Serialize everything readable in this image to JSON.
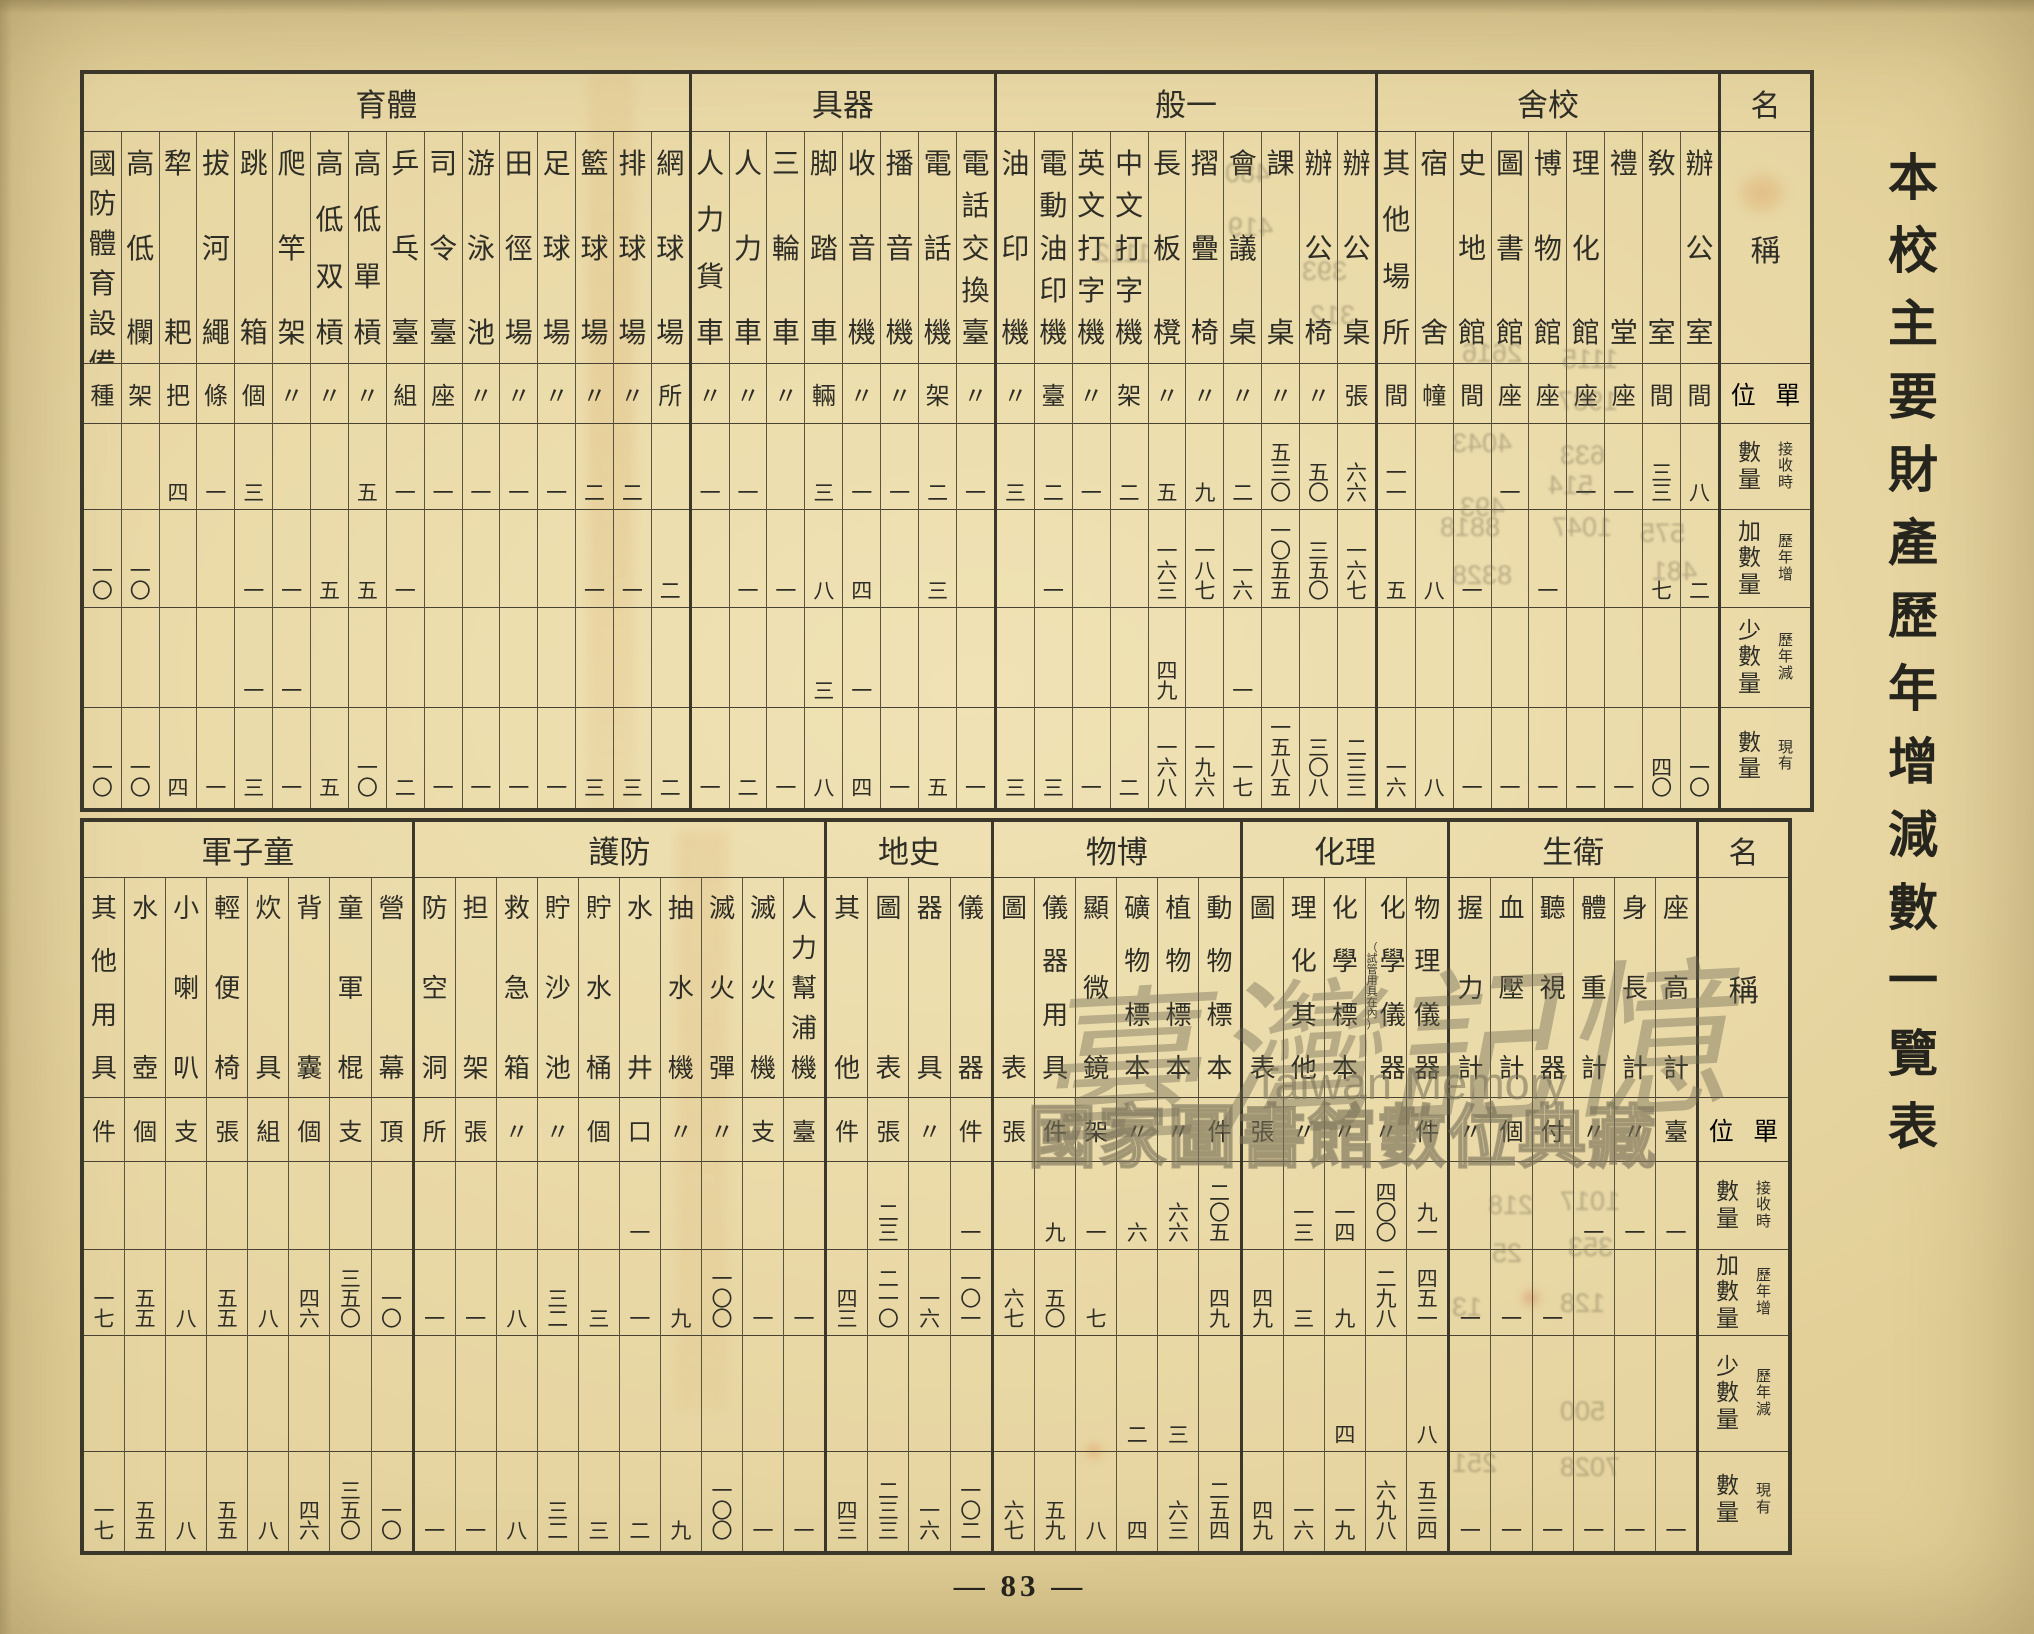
{
  "page": {
    "vertical_title": "本校主要財產歷年增減數一覽表",
    "page_number": "— 83 —",
    "watermark": {
      "line1": "臺灣記憶",
      "line2": "Taiwan Memory",
      "line3": "國家圖書館數位典藏"
    },
    "ink_color": "#2f2e26",
    "paper_color": "#e9d8a5",
    "line_color": "#474234"
  },
  "row_labels": {
    "name_header": "名",
    "item_header": "稱",
    "unit_label": "單位",
    "qty_rows": [
      {
        "main": "數量",
        "sub": "接收時"
      },
      {
        "main": "加數量",
        "sub": "歷年增"
      },
      {
        "main": "少數量",
        "sub": "歷年減"
      },
      {
        "main": "數量",
        "sub": "現有"
      }
    ]
  },
  "top_table": {
    "sections": [
      {
        "title": "校舍",
        "key": "school-buildings",
        "items": [
          {
            "name": "辦公室",
            "unit": "間",
            "received": "八",
            "added": "二",
            "reduced": "",
            "current": "一〇"
          },
          {
            "name": "敎室",
            "unit": "間",
            "received": "三三",
            "added": "七",
            "reduced": "",
            "current": "四〇"
          },
          {
            "name": "禮堂",
            "unit": "座",
            "received": "一",
            "added": "",
            "reduced": "",
            "current": "一"
          },
          {
            "name": "理化館",
            "unit": "座",
            "received": "一",
            "added": "",
            "reduced": "",
            "current": "一"
          },
          {
            "name": "博物館",
            "unit": "座",
            "received": "",
            "added": "一",
            "reduced": "",
            "current": "一"
          },
          {
            "name": "圖書館",
            "unit": "座",
            "received": "一",
            "added": "",
            "reduced": "",
            "current": "一"
          },
          {
            "name": "史地館",
            "unit": "間",
            "received": "",
            "added": "一",
            "reduced": "",
            "current": "一"
          },
          {
            "name": "宿舍",
            "unit": "幢",
            "received": "",
            "added": "八",
            "reduced": "",
            "current": "八"
          },
          {
            "name": "其他場所",
            "unit": "間",
            "received": "一一",
            "added": "五",
            "reduced": "",
            "current": "一六"
          }
        ]
      },
      {
        "title": "一般",
        "key": "general-furniture",
        "items": [
          {
            "name": "辦公桌",
            "unit": "張",
            "received": "六六",
            "added": "一六七",
            "reduced": "",
            "current": "二三三"
          },
          {
            "name": "辦公椅",
            "unit": "〃",
            "received": "五〇",
            "added": "三五〇",
            "reduced": "",
            "current": "三〇八"
          },
          {
            "name": "課桌",
            "unit": "〃",
            "received": "五三〇",
            "added": "一〇五五",
            "reduced": "",
            "current": "一五八五"
          },
          {
            "name": "會議桌",
            "unit": "〃",
            "received": "二",
            "added": "一六",
            "reduced": "一",
            "current": "一七"
          },
          {
            "name": "摺疊椅",
            "unit": "〃",
            "received": "九",
            "added": "一八七",
            "reduced": "",
            "current": "一九六"
          },
          {
            "name": "長板櫈",
            "unit": "〃",
            "received": "五",
            "added": "一六三",
            "reduced": "四九",
            "current": "一六八"
          },
          {
            "name": "中文打字機",
            "unit": "架",
            "received": "二",
            "added": "",
            "reduced": "",
            "current": "二"
          },
          {
            "name": "英文打字機",
            "unit": "〃",
            "received": "一",
            "added": "",
            "reduced": "",
            "current": "一"
          },
          {
            "name": "電動油印機",
            "unit": "臺",
            "received": "二",
            "added": "一",
            "reduced": "",
            "current": "三"
          },
          {
            "name": "油印機",
            "unit": "〃",
            "received": "三",
            "added": "",
            "reduced": "",
            "current": "三"
          }
        ]
      },
      {
        "title": "器具",
        "key": "equipment-vehicles",
        "items": [
          {
            "name": "電話交換臺",
            "unit": "〃",
            "received": "一",
            "added": "",
            "reduced": "",
            "current": "一"
          },
          {
            "name": "電話機",
            "unit": "架",
            "received": "二",
            "added": "三",
            "reduced": "",
            "current": "五"
          },
          {
            "name": "播音機",
            "unit": "〃",
            "received": "一",
            "added": "",
            "reduced": "",
            "current": "一"
          },
          {
            "name": "收音機",
            "unit": "〃",
            "received": "一",
            "added": "四",
            "reduced": "一",
            "current": "四"
          },
          {
            "name": "脚踏車",
            "unit": "輛",
            "received": "三",
            "added": "八",
            "reduced": "三",
            "current": "八"
          },
          {
            "name": "三輪車",
            "unit": "〃",
            "received": "",
            "added": "一",
            "reduced": "",
            "current": "一"
          },
          {
            "name": "人力車",
            "unit": "〃",
            "received": "一",
            "added": "一",
            "reduced": "",
            "current": "二"
          },
          {
            "name": "人力貨車",
            "unit": "〃",
            "received": "一",
            "added": "",
            "reduced": "",
            "current": "一"
          }
        ]
      },
      {
        "title": "體育",
        "key": "physical-education",
        "items": [
          {
            "name": "網球場",
            "unit": "所",
            "received": "",
            "added": "二",
            "reduced": "",
            "current": "二"
          },
          {
            "name": "排球場",
            "unit": "〃",
            "received": "二",
            "added": "一",
            "reduced": "",
            "current": "三"
          },
          {
            "name": "籃球場",
            "unit": "〃",
            "received": "二",
            "added": "一",
            "reduced": "",
            "current": "三"
          },
          {
            "name": "足球場",
            "unit": "〃",
            "received": "一",
            "added": "",
            "reduced": "",
            "current": "一"
          },
          {
            "name": "田徑場",
            "unit": "〃",
            "received": "一",
            "added": "",
            "reduced": "",
            "current": "一"
          },
          {
            "name": "游泳池",
            "unit": "〃",
            "received": "一",
            "added": "",
            "reduced": "",
            "current": "一"
          },
          {
            "name": "司令臺",
            "unit": "座",
            "received": "一",
            "added": "",
            "reduced": "",
            "current": "一"
          },
          {
            "name": "乒乓臺",
            "unit": "組",
            "received": "一",
            "added": "一",
            "reduced": "",
            "current": "二"
          },
          {
            "name": "高低單槓",
            "unit": "〃",
            "received": "五",
            "added": "五",
            "reduced": "",
            "current": "一〇"
          },
          {
            "name": "高低双槓",
            "unit": "〃",
            "received": "",
            "added": "五",
            "reduced": "",
            "current": "五"
          },
          {
            "name": "爬竿架",
            "unit": "〃",
            "received": "",
            "added": "一",
            "reduced": "一",
            "current": "一"
          },
          {
            "name": "跳箱",
            "unit": "個",
            "received": "三",
            "added": "一",
            "reduced": "一",
            "current": "三"
          },
          {
            "name": "拔河繩",
            "unit": "條",
            "received": "一",
            "added": "",
            "reduced": "",
            "current": "一"
          },
          {
            "name": "犂耙",
            "unit": "把",
            "received": "四",
            "added": "",
            "reduced": "",
            "current": "四"
          },
          {
            "name": "高低欄",
            "unit": "架",
            "received": "",
            "added": "一〇",
            "reduced": "",
            "current": "一〇"
          },
          {
            "name": "國防體育設備",
            "unit": "種",
            "received": "",
            "added": "一〇",
            "reduced": "",
            "current": "一〇"
          }
        ]
      }
    ]
  },
  "bottom_table": {
    "sections": [
      {
        "title": "衛生",
        "key": "hygiene",
        "items": [
          {
            "name": "座高計",
            "unit": "臺",
            "received": "一",
            "added": "",
            "reduced": "",
            "current": "一"
          },
          {
            "name": "身長計",
            "unit": "〃",
            "received": "一",
            "added": "",
            "reduced": "",
            "current": "一"
          },
          {
            "name": "體重計",
            "unit": "〃",
            "received": "一",
            "added": "",
            "reduced": "",
            "current": "一"
          },
          {
            "name": "聽視器",
            "unit": "付",
            "received": "",
            "added": "一",
            "reduced": "",
            "current": "一"
          },
          {
            "name": "血壓計",
            "unit": "個",
            "received": "",
            "added": "一",
            "reduced": "",
            "current": "一"
          },
          {
            "name": "握力計",
            "unit": "〃",
            "received": "",
            "added": "一",
            "reduced": "",
            "current": "一"
          }
        ]
      },
      {
        "title": "理化",
        "key": "physics-chemistry",
        "items": [
          {
            "name": "物理儀器",
            "unit": "件",
            "received": "九一",
            "added": "四五一",
            "reduced": "八",
            "current": "五三四"
          },
          {
            "name": "化學儀器",
            "note": "（試管用具在內）",
            "unit": "〃",
            "received": "四〇〇",
            "added": "二九八",
            "reduced": "",
            "current": "六九八"
          },
          {
            "name": "化學標本",
            "unit": "〃",
            "received": "一四",
            "added": "九",
            "reduced": "四",
            "current": "一九"
          },
          {
            "name": "理化其他",
            "unit": "〃",
            "received": "一三",
            "added": "三",
            "reduced": "",
            "current": "一六"
          },
          {
            "name": "圖表",
            "unit": "張",
            "received": "",
            "added": "四九",
            "reduced": "",
            "current": "四九"
          }
        ]
      },
      {
        "title": "博物",
        "key": "natural-history",
        "items": [
          {
            "name": "動物標本",
            "unit": "件",
            "received": "二〇五",
            "added": "四九",
            "reduced": "",
            "current": "二五四"
          },
          {
            "name": "植物標本",
            "unit": "〃",
            "received": "六六",
            "added": "",
            "reduced": "三",
            "current": "六三"
          },
          {
            "name": "礦物標本",
            "unit": "〃",
            "received": "六",
            "added": "",
            "reduced": "二",
            "current": "四"
          },
          {
            "name": "顯微鏡",
            "unit": "架",
            "received": "一",
            "added": "七",
            "reduced": "",
            "current": "八"
          },
          {
            "name": "儀器用具",
            "unit": "件",
            "received": "九",
            "added": "五〇",
            "reduced": "",
            "current": "五九"
          },
          {
            "name": "圖表",
            "unit": "張",
            "received": "",
            "added": "六七",
            "reduced": "",
            "current": "六七"
          }
        ]
      },
      {
        "title": "史地",
        "key": "history-geography",
        "items": [
          {
            "name": "儀器",
            "unit": "件",
            "received": "一",
            "added": "一〇一",
            "reduced": "",
            "current": "一〇二"
          },
          {
            "name": "器具",
            "unit": "〃",
            "received": "",
            "added": "一六",
            "reduced": "",
            "current": "一六"
          },
          {
            "name": "圖表",
            "unit": "張",
            "received": "二三",
            "added": "二一〇",
            "reduced": "",
            "current": "二三三"
          },
          {
            "name": "其他",
            "unit": "件",
            "received": "",
            "added": "四三",
            "reduced": "",
            "current": "四三"
          }
        ]
      },
      {
        "title": "防護",
        "key": "air-defense",
        "items": [
          {
            "name": "人力幫浦機",
            "unit": "臺",
            "received": "",
            "added": "一",
            "reduced": "",
            "current": "一"
          },
          {
            "name": "滅火機",
            "unit": "支",
            "received": "",
            "added": "一",
            "reduced": "",
            "current": "一"
          },
          {
            "name": "滅火彈",
            "unit": "〃",
            "received": "",
            "added": "一〇〇",
            "reduced": "",
            "current": "一〇〇"
          },
          {
            "name": "抽水機",
            "unit": "〃",
            "received": "",
            "added": "九",
            "reduced": "",
            "current": "九"
          },
          {
            "name": "水井",
            "unit": "口",
            "received": "一",
            "added": "一",
            "reduced": "",
            "current": "二"
          },
          {
            "name": "貯水桶",
            "unit": "個",
            "received": "",
            "added": "三",
            "reduced": "",
            "current": "三"
          },
          {
            "name": "貯沙池",
            "unit": "〃",
            "received": "",
            "added": "三二",
            "reduced": "",
            "current": "三二"
          },
          {
            "name": "救急箱",
            "unit": "〃",
            "received": "",
            "added": "八",
            "reduced": "",
            "current": "八"
          },
          {
            "name": "担架",
            "unit": "張",
            "received": "",
            "added": "一",
            "reduced": "",
            "current": "一"
          },
          {
            "name": "防空洞",
            "unit": "所",
            "received": "",
            "added": "一",
            "reduced": "",
            "current": "一"
          }
        ]
      },
      {
        "title": "童子軍",
        "key": "boy-scouts",
        "items": [
          {
            "name": "營幕",
            "unit": "頂",
            "received": "",
            "added": "一〇",
            "reduced": "",
            "current": "一〇"
          },
          {
            "name": "童軍棍",
            "unit": "支",
            "received": "",
            "added": "三五〇",
            "reduced": "",
            "current": "三五〇"
          },
          {
            "name": "背囊",
            "unit": "個",
            "received": "",
            "added": "四六",
            "reduced": "",
            "current": "四六"
          },
          {
            "name": "炊具",
            "unit": "組",
            "received": "",
            "added": "八",
            "reduced": "",
            "current": "八"
          },
          {
            "name": "輕便椅",
            "unit": "張",
            "received": "",
            "added": "五五",
            "reduced": "",
            "current": "五五"
          },
          {
            "name": "小喇叭",
            "unit": "支",
            "received": "",
            "added": "八",
            "reduced": "",
            "current": "八"
          },
          {
            "name": "水壺",
            "unit": "個",
            "received": "",
            "added": "五五",
            "reduced": "",
            "current": "五五"
          },
          {
            "name": "其他用具",
            "unit": "件",
            "received": "",
            "added": "一七",
            "reduced": "",
            "current": "一七"
          }
        ]
      }
    ]
  },
  "bleed_through_numbers": [
    {
      "text": "480",
      "x": 1225,
      "y": 158
    },
    {
      "text": "419",
      "x": 1228,
      "y": 212
    },
    {
      "text": "1112",
      "x": 1095,
      "y": 238
    },
    {
      "text": "393",
      "x": 1302,
      "y": 256
    },
    {
      "text": "312",
      "x": 1310,
      "y": 300
    },
    {
      "text": "2616",
      "x": 1462,
      "y": 338
    },
    {
      "text": "1115",
      "x": 1562,
      "y": 344
    },
    {
      "text": "1987",
      "x": 1558,
      "y": 386
    },
    {
      "text": "4043",
      "x": 1452,
      "y": 428
    },
    {
      "text": "633",
      "x": 1560,
      "y": 440
    },
    {
      "text": "514",
      "x": 1548,
      "y": 470
    },
    {
      "text": "493",
      "x": 1460,
      "y": 492
    },
    {
      "text": "8818",
      "x": 1440,
      "y": 512
    },
    {
      "text": "1047",
      "x": 1552,
      "y": 512
    },
    {
      "text": "575",
      "x": 1640,
      "y": 518
    },
    {
      "text": "8328",
      "x": 1452,
      "y": 560
    },
    {
      "text": "481",
      "x": 1652,
      "y": 556
    },
    {
      "text": "218",
      "x": 1488,
      "y": 1190
    },
    {
      "text": "1017",
      "x": 1560,
      "y": 1186
    },
    {
      "text": "353",
      "x": 1568,
      "y": 1232
    },
    {
      "text": "25",
      "x": 1492,
      "y": 1238
    },
    {
      "text": "128",
      "x": 1560,
      "y": 1288
    },
    {
      "text": "13",
      "x": 1452,
      "y": 1292
    },
    {
      "text": "500",
      "x": 1560,
      "y": 1396
    },
    {
      "text": "251",
      "x": 1452,
      "y": 1448
    },
    {
      "text": "7028",
      "x": 1560,
      "y": 1452
    }
  ]
}
